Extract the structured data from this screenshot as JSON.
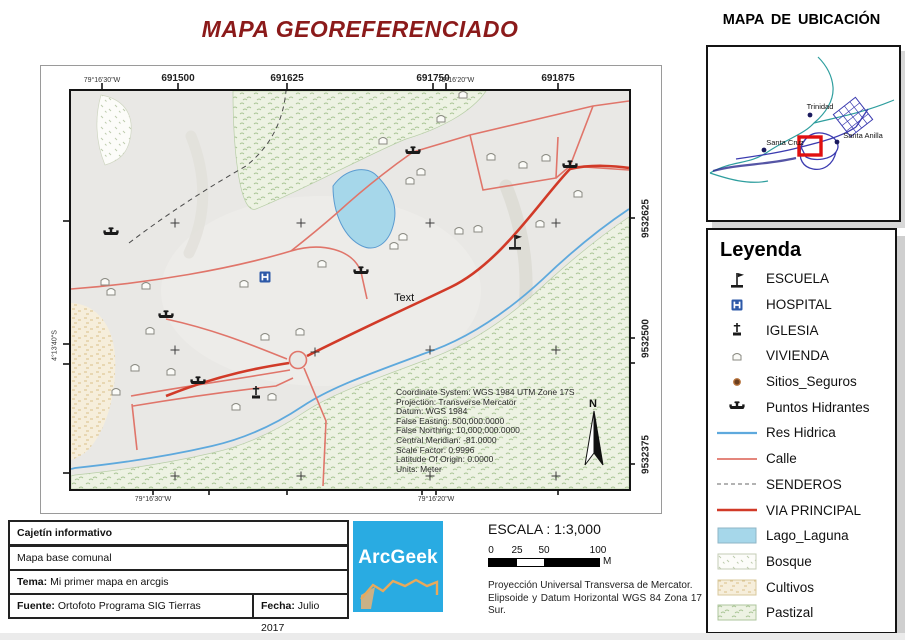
{
  "titles": {
    "main": "MAPA GEOREFERENCIADO",
    "location": "MAPA  DE UBICACIÓN",
    "legend": "Leyenda"
  },
  "map": {
    "axis": {
      "top": {
        "geo_left": "79°16'30\"W",
        "utm1": "691500",
        "utm2": "691625",
        "utm3": "691750",
        "geo_right": "79°16'20\"W",
        "utm4": "691875"
      },
      "bottom": {
        "geo_left": "79°16'30\"W",
        "geo_right": "79°16'20\"W"
      },
      "left": {
        "geo": "4°13'40\"S"
      },
      "right": {
        "utm1": "9532625",
        "geo_overlap": "4°13'",
        "utm2": "9532500",
        "utm3": "9532375"
      }
    },
    "labels": {
      "text_annotation": "Text",
      "north": "N"
    },
    "coordinate_info": {
      "lines": [
        "Coordinate System: WGS 1984 UTM Zone 17S",
        "Projection: Transverse Mercator",
        "Datum: WGS 1984",
        "False Easting: 500,000.0000",
        "False Northing: 10,000,000.0000",
        "Central Meridian: -81.0000",
        "Scale Factor: 0.9996",
        "Latitude Of Origin: 0.0000",
        "Units: Meter"
      ]
    }
  },
  "location_map": {
    "towns": [
      {
        "name": "Trinidad"
      },
      {
        "name": "Santa Cruz"
      },
      {
        "name": "Santa Anilla"
      }
    ]
  },
  "legend": {
    "items": [
      {
        "icon": "school-flag-icon",
        "label": "ESCUELA"
      },
      {
        "icon": "hospital-icon",
        "label": "HOSPITAL"
      },
      {
        "icon": "church-icon",
        "label": "IGLESIA"
      },
      {
        "icon": "house-icon",
        "label": "VIVIENDA"
      },
      {
        "icon": "safe-site-dot-icon",
        "label": "Sitios_Seguros"
      },
      {
        "icon": "hydrant-icon",
        "label": "Puntos Hidrantes"
      },
      {
        "icon": "blue-line",
        "label": "Res Hidrica"
      },
      {
        "icon": "salmon-line",
        "label": "Calle"
      },
      {
        "icon": "dashed-line",
        "label": "SENDEROS"
      },
      {
        "icon": "red-line",
        "label": "VIA PRINCIPAL"
      },
      {
        "icon": "lake-swatch",
        "label": "Lago_Laguna"
      },
      {
        "icon": "bosque-swatch",
        "label": "Bosque"
      },
      {
        "icon": "cultivos-swatch",
        "label": "Cultivos"
      },
      {
        "icon": "pastizal-swatch",
        "label": "Pastizal"
      }
    ]
  },
  "cajetin": {
    "header": "Cajetín informativo",
    "row2": "Mapa base comunal",
    "tema_label": "Tema:",
    "tema_value": " Mi primer mapa en arcgis",
    "fuente_label": "Fuente:",
    "fuente_value": " Ortofoto Programa SIG Tierras",
    "fecha_label": "Fecha:",
    "fecha_value": " Julio 2017"
  },
  "logo": {
    "text": "ArcGeek"
  },
  "scale": {
    "title": "ESCALA : 1:3,000",
    "ticks": [
      "0",
      "25",
      "50",
      "100"
    ],
    "unit": "M",
    "note_line1": "Proyección Universal Transversa de Mercator.",
    "note_line2": "Elipsoide y Datum Horizontal WGS 84 Zona 17 Sur."
  },
  "colors": {
    "title": "#8b1a1a",
    "arcgeek_blue": "#29abe2",
    "hospital_blue": "#2d59a8",
    "via_principal": "#d13a28",
    "calle": "#e0756a",
    "river": "#5ea9dd",
    "lake_fill": "#a6d7ea",
    "pastizal_bg": "#edf2e3",
    "cultivos_bg": "#f6eedb",
    "bosque_bg": "#fcfcf9",
    "terrain_bg": "#e9e8e5",
    "location_river_teal": "#2e9e9e",
    "location_road_navy": "#3b3bb0",
    "highlight_red": "#e01010"
  }
}
